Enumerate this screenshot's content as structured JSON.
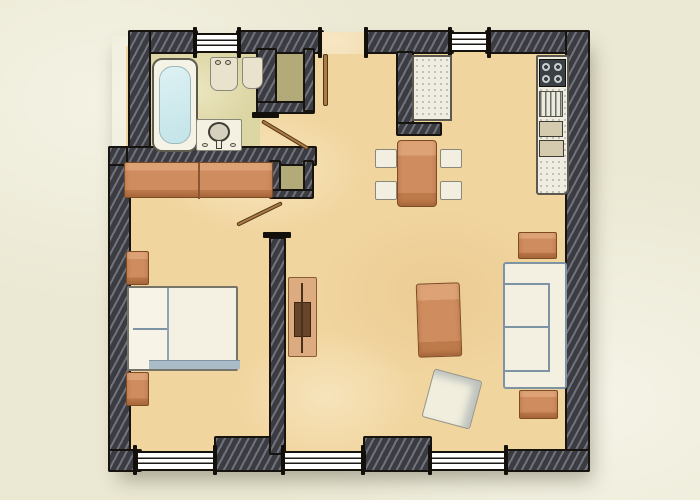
{
  "scene": {
    "type": "architectural floor plan",
    "style": "hand-drawn watercolor sketch, top-down view",
    "rooms": [
      "bathroom",
      "entry-hall",
      "bedroom",
      "kitchen-dining",
      "living-area"
    ],
    "window_count": 5,
    "door_leaf_count": 3,
    "text_labels": []
  },
  "colors": {
    "paper": "#ebe8d3",
    "floor_tan": "#f1d59f",
    "floor_bathroom": "#dcd5a4",
    "floor_olive_niche": "#b2aa79",
    "wall_dark": "#3b3b42",
    "wall_hatch_light": "#72727c",
    "ink_outline": "#17130e",
    "furniture_terracotta": "#cf8c5e",
    "furniture_white": "#f2efe1",
    "bathtub_water": "#cdeaed",
    "sofa_sketch_blue": "#7e94a4",
    "door_leaf_wood": "#ab7b46",
    "stove_top": "#3a4045",
    "tv_screen_brown": "#66452a"
  },
  "furniture": {
    "bathroom": [
      "bathtub",
      "toilet",
      "bidet",
      "washbasin-stand"
    ],
    "kitchen": [
      "refrigerator",
      "counter-run",
      "cooktop-4-burner",
      "sink-drainer",
      "base-cabinet",
      "base-cabinet"
    ],
    "dining": [
      "dining-table",
      "chair",
      "chair",
      "chair",
      "chair"
    ],
    "living": [
      "sofa-two-seat",
      "side-table",
      "side-table",
      "coffee-table",
      "floor-cushion",
      "tv-unit"
    ],
    "bedroom": [
      "wardrobe-two-door",
      "double-bed",
      "nightstand",
      "nightstand"
    ]
  }
}
